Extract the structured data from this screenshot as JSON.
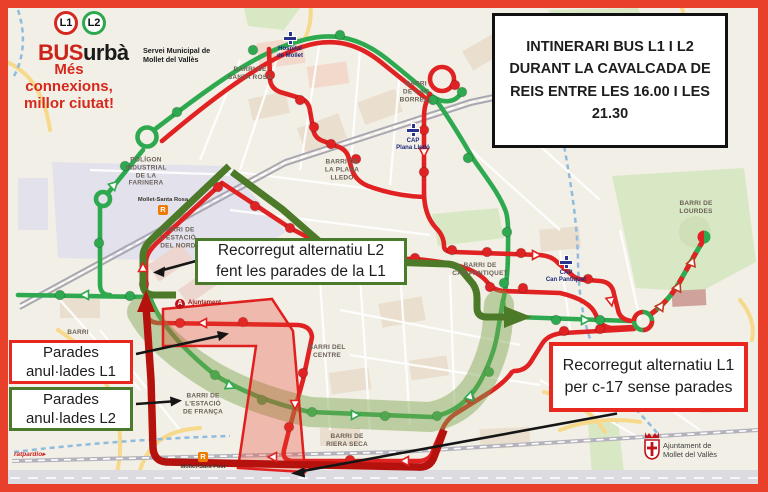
{
  "frame_color": "#e8402a",
  "header": {
    "badges": [
      {
        "label": "L1",
        "ring": "#d5281f"
      },
      {
        "label": "L2",
        "ring": "#2ca84e"
      }
    ],
    "brand": {
      "red": "BUS",
      "black": "urbà"
    },
    "subtitle": "Servei Municipal de\nMollet del Vallès",
    "slogan": "Més connexions,\nmillor ciutat!"
  },
  "info_box": {
    "text": "INTINERARI BUS L1 I L2\nDURANT LA CAVALCADA DE\nREIS ENTRE LES 16.00 I LES\n21.30"
  },
  "callouts": {
    "alt_l2": {
      "text": "Recorregut alternatiu L2\nfent les parades de la L1",
      "border": "#4a7a2b"
    },
    "parades_l1": {
      "text": "Parades\nanul·lades L1",
      "border": "#e8281e"
    },
    "parades_l2": {
      "text": "Parades\nanul·lades L2",
      "border": "#4a7a2b"
    },
    "alt_l1": {
      "text": "Recorregut alternatiu L1\nper c-17 sense parades",
      "border": "#e8281e"
    }
  },
  "map": {
    "labels": [
      {
        "id": "santa-rosa",
        "text": "BARRI DE\nSANTA ROSA",
        "x": 250,
        "y": 74
      },
      {
        "id": "can-borrell",
        "text": "BARRI\nDE CAN\nBORRELL",
        "x": 416,
        "y": 92
      },
      {
        "id": "plana-lledo",
        "text": "BARRI DE\nLA PLANA\nLLEDÓ",
        "x": 342,
        "y": 170
      },
      {
        "id": "farinera",
        "text": "POLÍGON\nINDUSTRIAL\nDE LA\nFARINERA",
        "x": 146,
        "y": 172
      },
      {
        "id": "estacio-nord",
        "text": "BARRI DE\nL'ESTACIÓ\nDEL NORD",
        "x": 178,
        "y": 238
      },
      {
        "id": "lourdes",
        "text": "BARRI DE\nLOURDES",
        "x": 696,
        "y": 208
      },
      {
        "id": "can-pantiquet",
        "text": "BARRI DE\nCAN PANTIQUET",
        "x": 480,
        "y": 270
      },
      {
        "id": "centre",
        "text": "BARRI DEL\nCENTRE",
        "x": 327,
        "y": 352
      },
      {
        "id": "estacio-franca",
        "text": "BARRI DE\nL'ESTACIÓ\nDE FRANÇA",
        "x": 203,
        "y": 404
      },
      {
        "id": "riera-seca",
        "text": "BARRI DE\nRIERA SECA",
        "x": 347,
        "y": 441
      },
      {
        "id": "barri-west",
        "text": "BARRI",
        "x": 78,
        "y": 333
      }
    ],
    "pois": [
      {
        "id": "hospital-de-mollet",
        "type": "health",
        "label": "Hospital\nde Mollet",
        "x": 290,
        "y": 38
      },
      {
        "id": "cap-plana-lledo",
        "type": "health",
        "label": "CAP\nPlana Lledó",
        "x": 413,
        "y": 130
      },
      {
        "id": "cap-can-pantiquet",
        "type": "health",
        "label": "CAP\nCan Pantiquet",
        "x": 566,
        "y": 262
      },
      {
        "id": "ajuntament",
        "type": "townhall",
        "label": "Ajuntament",
        "x": 180,
        "y": 304
      },
      {
        "id": "mollet-santa-rosa",
        "type": "rail",
        "label": "Mollet-Santa Rosa",
        "x": 163,
        "y": 210,
        "label_pos": "above"
      },
      {
        "id": "mollet-sant-fost",
        "type": "rail",
        "label": "Mollet-Sant Fost",
        "x": 203,
        "y": 457,
        "label_pos": "below"
      }
    ],
    "stops": {
      "l1": [
        [
          270,
          75
        ],
        [
          300,
          100
        ],
        [
          314,
          127
        ],
        [
          331,
          144
        ],
        [
          356,
          159
        ],
        [
          424,
          130
        ],
        [
          424,
          172
        ],
        [
          218,
          187
        ],
        [
          255,
          206
        ],
        [
          290,
          228
        ],
        [
          325,
          248
        ],
        [
          375,
          258
        ],
        [
          415,
          258
        ],
        [
          144,
          284
        ],
        [
          180,
          323
        ],
        [
          243,
          322
        ],
        [
          303,
          373
        ],
        [
          289,
          427
        ],
        [
          350,
          460
        ],
        [
          452,
          250
        ],
        [
          487,
          252
        ],
        [
          521,
          253
        ],
        [
          588,
          279
        ],
        [
          600,
          329
        ],
        [
          564,
          331
        ],
        [
          490,
          287
        ],
        [
          523,
          288
        ],
        [
          470,
          399
        ],
        [
          455,
          85
        ]
      ],
      "l2": [
        [
          60,
          295
        ],
        [
          130,
          296
        ],
        [
          99,
          243
        ],
        [
          125,
          166
        ],
        [
          177,
          112
        ],
        [
          253,
          50
        ],
        [
          340,
          35
        ],
        [
          433,
          100
        ],
        [
          468,
          158
        ],
        [
          507,
          232
        ],
        [
          504,
          283
        ],
        [
          556,
          320
        ],
        [
          600,
          320
        ],
        [
          462,
          92
        ],
        [
          215,
          375
        ],
        [
          262,
          400
        ],
        [
          312,
          412
        ],
        [
          385,
          416
        ],
        [
          437,
          416
        ],
        [
          489,
          372
        ]
      ]
    },
    "colors": {
      "l1": "#e02222",
      "l2": "#2fa94f",
      "alt_l1": "#b5120e",
      "alt_l2": "#4d7a28",
      "zone_l1": "rgba(232,58,43,0.30)",
      "zone_l2": "rgba(122,165,78,0.45)"
    }
  },
  "footer": {
    "municipality": "Ajuntament de\nMollet del Vallès"
  },
  "watermark": "ratpardio▸"
}
